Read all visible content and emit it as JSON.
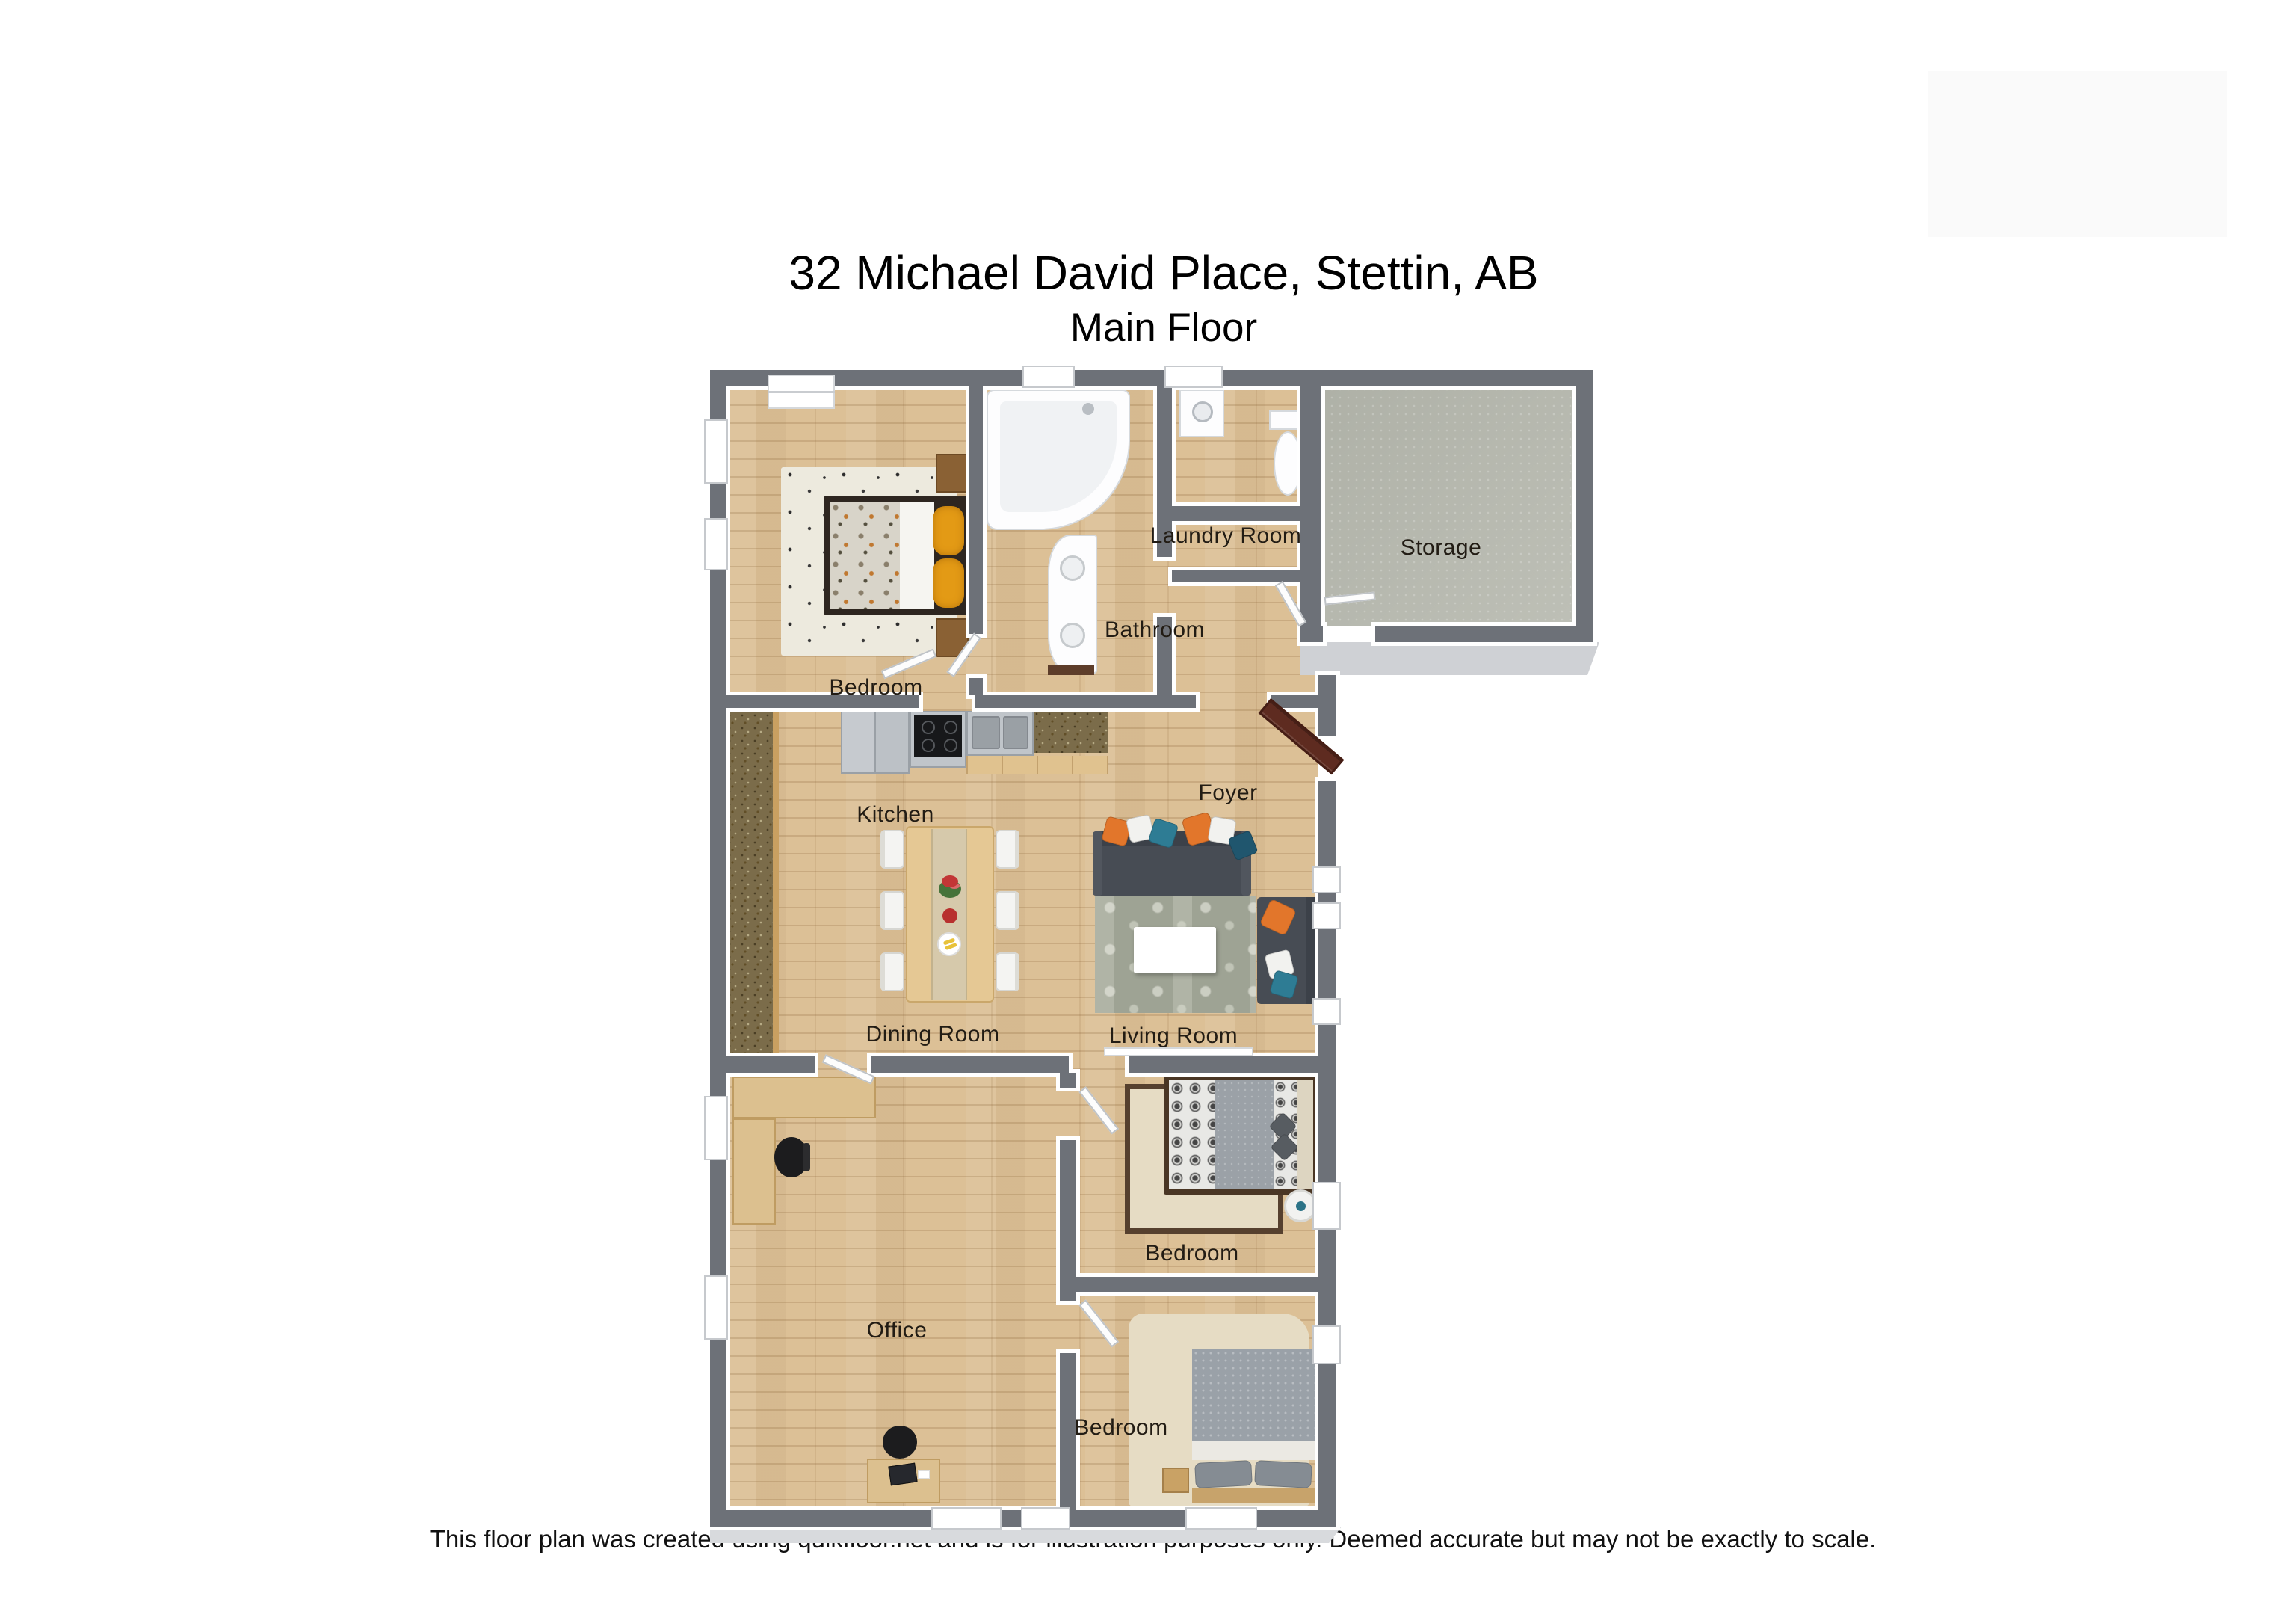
{
  "page": {
    "title": "32 Michael David Place, Stettin, AB",
    "subtitle": "Main Floor",
    "footer": "This floor plan was created using quikfloor.net and is for illustration purposes only. Deemed accurate but may not be exactly to scale."
  },
  "floorplan": {
    "rooms": [
      {
        "name": "bedroom-top",
        "label": "Bedroom"
      },
      {
        "name": "bathroom",
        "label": "Bathroom"
      },
      {
        "name": "laundry-room",
        "label": "Laundry Room"
      },
      {
        "name": "storage",
        "label": "Storage"
      },
      {
        "name": "kitchen",
        "label": "Kitchen"
      },
      {
        "name": "foyer",
        "label": "Foyer"
      },
      {
        "name": "dining-room",
        "label": "Dining Room"
      },
      {
        "name": "living-room",
        "label": "Living Room"
      },
      {
        "name": "bedroom-middle",
        "label": "Bedroom"
      },
      {
        "name": "office",
        "label": "Office"
      },
      {
        "name": "bedroom-bottom",
        "label": "Bedroom"
      }
    ],
    "colors": {
      "wall": "#6d7178",
      "wood_floor": "#dcc096",
      "storage_floor": "#b8bab0",
      "granite_counter": "#7b6c4a",
      "sofa_gray": "#474c54",
      "accent_orange": "#e2762b",
      "accent_teal": "#2e7c94",
      "pillow_gold": "#e39a15",
      "front_door_brown": "#5e2b20",
      "rug_living": "#a7ac9c",
      "rug_beige": "#e6dcc4"
    }
  }
}
